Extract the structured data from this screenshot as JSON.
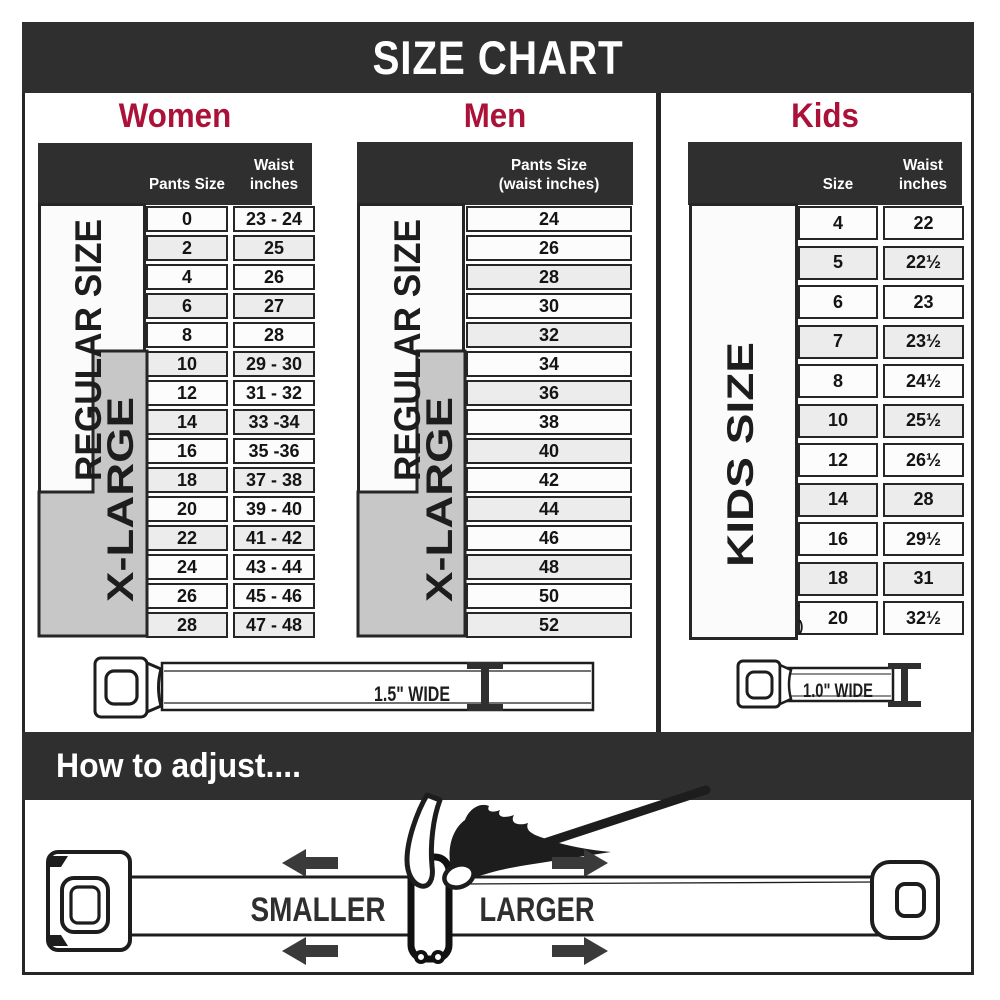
{
  "title": "SIZE CHART",
  "colors": {
    "accent": "#ab1239",
    "band_dark": "#2f2f2f",
    "row_alt": "#ececec",
    "xlarge_band": "#c7c7c7"
  },
  "sections": {
    "women": {
      "heading": "Women",
      "col1_header": "Pants Size",
      "col2_header_line1": "Waist",
      "col2_header_line2": "inches",
      "regular_label": "REGULAR SIZE",
      "xlarge_label": "X-LARGE",
      "rows": [
        {
          "size": "0",
          "waist": "23 - 24"
        },
        {
          "size": "2",
          "waist": "25"
        },
        {
          "size": "4",
          "waist": "26"
        },
        {
          "size": "6",
          "waist": "27"
        },
        {
          "size": "8",
          "waist": "28"
        },
        {
          "size": "10",
          "waist": "29 - 30"
        },
        {
          "size": "12",
          "waist": "31 - 32"
        },
        {
          "size": "14",
          "waist": "33 -34"
        },
        {
          "size": "16",
          "waist": "35 -36"
        },
        {
          "size": "18",
          "waist": "37 - 38"
        },
        {
          "size": "20",
          "waist": "39 - 40"
        },
        {
          "size": "22",
          "waist": "41 - 42"
        },
        {
          "size": "24",
          "waist": "43 - 44"
        },
        {
          "size": "26",
          "waist": "45 - 46"
        },
        {
          "size": "28",
          "waist": "47 - 48"
        }
      ]
    },
    "men": {
      "heading": "Men",
      "col1_header_line1": "Pants Size",
      "col1_header_line2": "(waist inches)",
      "regular_label": "REGULAR SIZE",
      "xlarge_label": "X-LARGE",
      "rows": [
        "24",
        "26",
        "28",
        "30",
        "32",
        "34",
        "36",
        "38",
        "40",
        "42",
        "44",
        "46",
        "48",
        "50",
        "52"
      ]
    },
    "kids": {
      "heading": "Kids",
      "col1_header": "Size",
      "col2_header_line1": "Waist",
      "col2_header_line2": "inches",
      "side_label": "KIDS SIZE",
      "note_line1": "Note:",
      "note_line2": "Not intended for",
      "note_line3": "Toddler Sizes (T)",
      "rows": [
        {
          "size": "4",
          "waist": "22"
        },
        {
          "size": "5",
          "waist": "22½"
        },
        {
          "size": "6",
          "waist": "23"
        },
        {
          "size": "7",
          "waist": "23½"
        },
        {
          "size": "8",
          "waist": "24½"
        },
        {
          "size": "10",
          "waist": "25½"
        },
        {
          "size": "12",
          "waist": "26½"
        },
        {
          "size": "14",
          "waist": "28"
        },
        {
          "size": "16",
          "waist": "29½"
        },
        {
          "size": "18",
          "waist": "31"
        },
        {
          "size": "20",
          "waist": "32½"
        }
      ]
    }
  },
  "belts": {
    "adult_width_label": "1.5\" WIDE",
    "kids_width_label": "1.0\" WIDE"
  },
  "adjust": {
    "heading": "How to adjust....",
    "smaller_label": "SMALLER",
    "larger_label": "LARGER"
  }
}
